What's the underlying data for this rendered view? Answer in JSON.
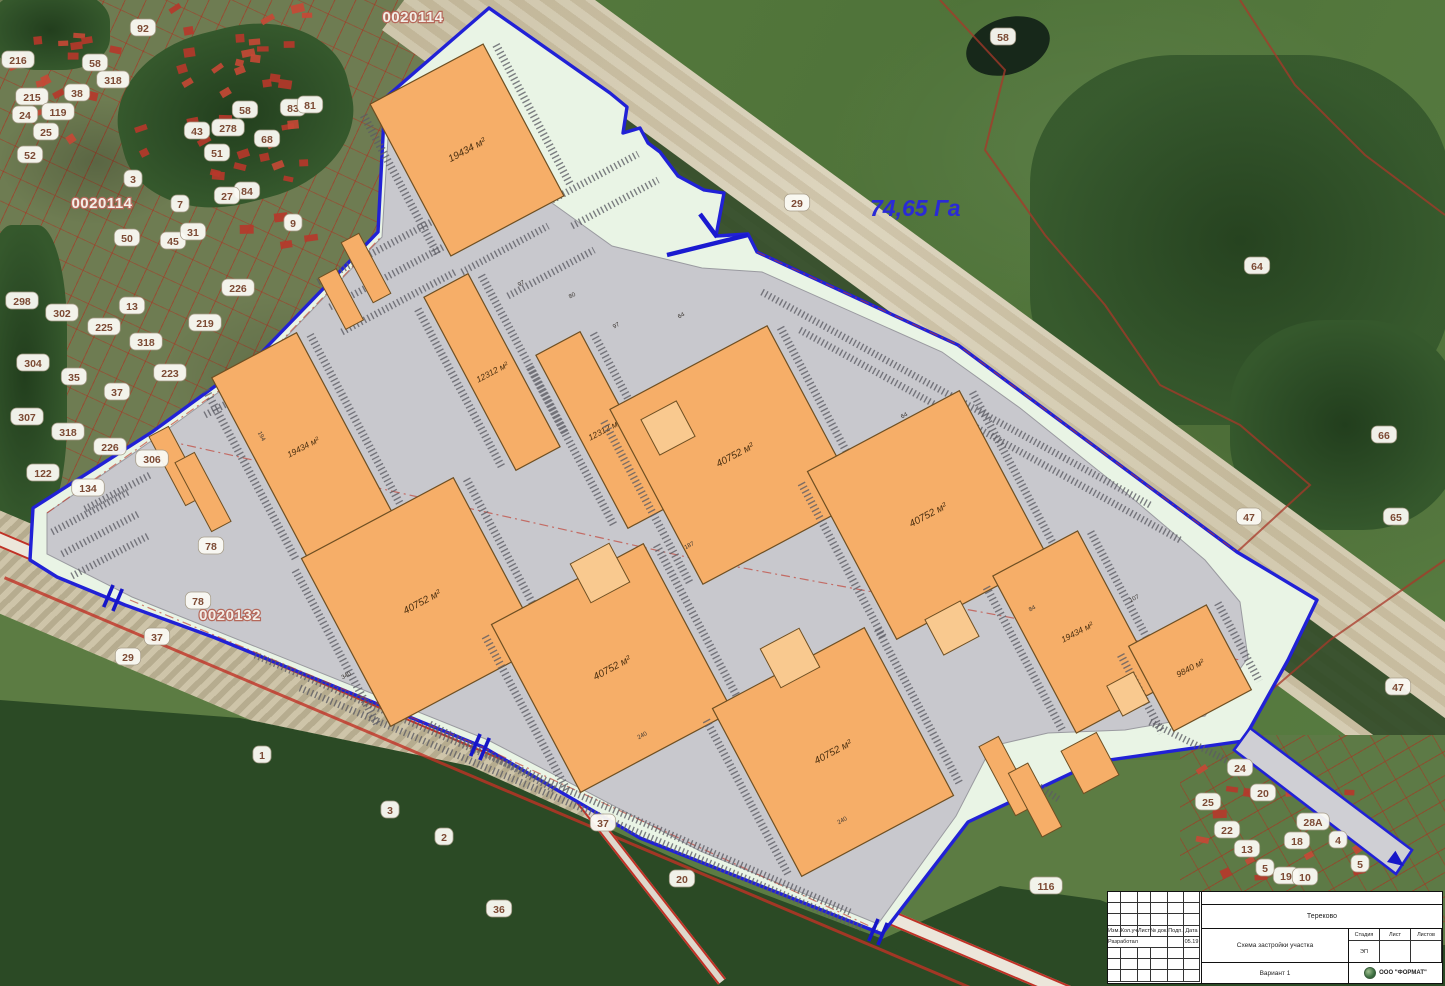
{
  "map": {
    "area_label": "74,65 Га",
    "cadastral_labels": [
      {
        "x": 413,
        "y": 22,
        "text": "0020114"
      },
      {
        "x": 102,
        "y": 208,
        "text": "0020114"
      },
      {
        "x": 230,
        "y": 620,
        "text": "0020132"
      }
    ],
    "buildings": [
      {
        "cx": 467,
        "cy": 150,
        "w": 128,
        "h": 172,
        "label": "19434 м²"
      },
      {
        "cx": 492,
        "cy": 372,
        "w": 50,
        "h": 196,
        "label": "12312 м²"
      },
      {
        "cx": 604,
        "cy": 430,
        "w": 50,
        "h": 196,
        "label": "12312 м²"
      },
      {
        "cx": 303,
        "cy": 447,
        "w": 96,
        "h": 208,
        "label": "19434 м²"
      },
      {
        "cx": 735,
        "cy": 455,
        "w": 178,
        "h": 198,
        "label": "40752 м²"
      },
      {
        "cx": 928,
        "cy": 515,
        "w": 172,
        "h": 190,
        "label": "40752 м²"
      },
      {
        "cx": 422,
        "cy": 602,
        "w": 172,
        "h": 190,
        "label": "40752 м²"
      },
      {
        "cx": 612,
        "cy": 668,
        "w": 172,
        "h": 190,
        "label": "40752 м²"
      },
      {
        "cx": 833,
        "cy": 752,
        "w": 172,
        "h": 190,
        "label": "40752 м²"
      },
      {
        "cx": 1077,
        "cy": 632,
        "w": 96,
        "h": 178,
        "label": "19434 м²"
      },
      {
        "cx": 1190,
        "cy": 668,
        "w": 88,
        "h": 96,
        "label": "9840 м²"
      }
    ],
    "dimension_labels": [
      {
        "x": 522,
        "y": 285,
        "t": "97"
      },
      {
        "x": 573,
        "y": 297,
        "t": "80"
      },
      {
        "x": 682,
        "y": 317,
        "t": "64"
      },
      {
        "x": 617,
        "y": 327,
        "t": "97"
      },
      {
        "x": 260,
        "y": 437,
        "t": "194",
        "r": 62
      },
      {
        "x": 1033,
        "y": 610,
        "t": "84"
      },
      {
        "x": 690,
        "y": 547,
        "t": "187"
      },
      {
        "x": 643,
        "y": 737,
        "t": "240"
      },
      {
        "x": 843,
        "y": 822,
        "t": "240"
      },
      {
        "x": 347,
        "y": 677,
        "t": "340"
      },
      {
        "x": 905,
        "y": 417,
        "t": "64"
      },
      {
        "x": 1135,
        "y": 600,
        "t": "107"
      }
    ],
    "parcel_bubbles": [
      {
        "x": 18,
        "y": 60,
        "t": "216"
      },
      {
        "x": 95,
        "y": 63,
        "t": "58"
      },
      {
        "x": 113,
        "y": 80,
        "t": "318"
      },
      {
        "x": 143,
        "y": 28,
        "t": "92"
      },
      {
        "x": 32,
        "y": 97,
        "t": "215"
      },
      {
        "x": 77,
        "y": 93,
        "t": "38"
      },
      {
        "x": 58,
        "y": 112,
        "t": "119"
      },
      {
        "x": 25,
        "y": 115,
        "t": "24"
      },
      {
        "x": 46,
        "y": 132,
        "t": "25"
      },
      {
        "x": 30,
        "y": 155,
        "t": "52"
      },
      {
        "x": 245,
        "y": 110,
        "t": "58"
      },
      {
        "x": 197,
        "y": 131,
        "t": "43"
      },
      {
        "x": 228,
        "y": 128,
        "t": "278"
      },
      {
        "x": 217,
        "y": 153,
        "t": "51"
      },
      {
        "x": 267,
        "y": 139,
        "t": "68"
      },
      {
        "x": 293,
        "y": 108,
        "t": "83"
      },
      {
        "x": 310,
        "y": 105,
        "t": "81"
      },
      {
        "x": 247,
        "y": 191,
        "t": "84"
      },
      {
        "x": 227,
        "y": 196,
        "t": "27"
      },
      {
        "x": 293,
        "y": 223,
        "t": "9"
      },
      {
        "x": 133,
        "y": 179,
        "t": "3"
      },
      {
        "x": 180,
        "y": 204,
        "t": "7"
      },
      {
        "x": 127,
        "y": 238,
        "t": "50"
      },
      {
        "x": 173,
        "y": 241,
        "t": "45"
      },
      {
        "x": 193,
        "y": 232,
        "t": "31"
      },
      {
        "x": 22,
        "y": 301,
        "t": "298"
      },
      {
        "x": 62,
        "y": 313,
        "t": "302"
      },
      {
        "x": 104,
        "y": 327,
        "t": "225"
      },
      {
        "x": 146,
        "y": 342,
        "t": "318"
      },
      {
        "x": 33,
        "y": 363,
        "t": "304"
      },
      {
        "x": 74,
        "y": 377,
        "t": "35"
      },
      {
        "x": 117,
        "y": 392,
        "t": "37"
      },
      {
        "x": 27,
        "y": 417,
        "t": "307"
      },
      {
        "x": 68,
        "y": 432,
        "t": "318"
      },
      {
        "x": 110,
        "y": 447,
        "t": "226"
      },
      {
        "x": 152,
        "y": 459,
        "t": "306"
      },
      {
        "x": 43,
        "y": 473,
        "t": "122"
      },
      {
        "x": 88,
        "y": 488,
        "t": "134"
      },
      {
        "x": 132,
        "y": 306,
        "t": "13"
      },
      {
        "x": 170,
        "y": 373,
        "t": "223"
      },
      {
        "x": 205,
        "y": 323,
        "t": "219"
      },
      {
        "x": 238,
        "y": 288,
        "t": "226"
      },
      {
        "x": 1003,
        "y": 37,
        "t": "58"
      },
      {
        "x": 797,
        "y": 203,
        "t": "29"
      },
      {
        "x": 1257,
        "y": 266,
        "t": "64"
      },
      {
        "x": 1384,
        "y": 435,
        "t": "66"
      },
      {
        "x": 1249,
        "y": 517,
        "t": "47"
      },
      {
        "x": 1396,
        "y": 517,
        "t": "65"
      },
      {
        "x": 1398,
        "y": 687,
        "t": "47"
      },
      {
        "x": 211,
        "y": 546,
        "t": "78"
      },
      {
        "x": 198,
        "y": 601,
        "t": "78"
      },
      {
        "x": 157,
        "y": 637,
        "t": "37"
      },
      {
        "x": 128,
        "y": 657,
        "t": "29"
      },
      {
        "x": 262,
        "y": 755,
        "t": "1"
      },
      {
        "x": 390,
        "y": 810,
        "t": "3"
      },
      {
        "x": 444,
        "y": 837,
        "t": "2"
      },
      {
        "x": 499,
        "y": 909,
        "t": "36"
      },
      {
        "x": 603,
        "y": 823,
        "t": "37"
      },
      {
        "x": 682,
        "y": 879,
        "t": "20"
      },
      {
        "x": 1046,
        "y": 886,
        "t": "116"
      },
      {
        "x": 1240,
        "y": 768,
        "t": "24"
      },
      {
        "x": 1263,
        "y": 793,
        "t": "20"
      },
      {
        "x": 1208,
        "y": 802,
        "t": "25"
      },
      {
        "x": 1227,
        "y": 830,
        "t": "22"
      },
      {
        "x": 1313,
        "y": 822,
        "t": "28А"
      },
      {
        "x": 1297,
        "y": 841,
        "t": "18"
      },
      {
        "x": 1338,
        "y": 840,
        "t": "4"
      },
      {
        "x": 1247,
        "y": 849,
        "t": "13"
      },
      {
        "x": 1286,
        "y": 876,
        "t": "19"
      },
      {
        "x": 1265,
        "y": 868,
        "t": "5"
      },
      {
        "x": 1305,
        "y": 877,
        "t": "10"
      },
      {
        "x": 1360,
        "y": 864,
        "t": "5"
      }
    ]
  },
  "title_block": {
    "project_name": "Тереково",
    "document_title": "Схема застройки участка",
    "variant": "Вариант 1",
    "company": "ООО \"ФОРМАТ\"",
    "columns": [
      "Изм.",
      "Кол.уч",
      "Лист",
      "№ док.",
      "Подп.",
      "Дата"
    ],
    "developed_by_label": "Разработал",
    "date_value": "05.19",
    "stage_label": "Стадия",
    "sheet_label": "Лист",
    "sheets_label": "Листов",
    "stage_value": "ЭП"
  },
  "colors": {
    "boundary": "#2121d6",
    "site_fill": "#e9f4e5",
    "paved": "#c8c8cd",
    "building": "#f6ae68",
    "annex": "#f9c98f",
    "building_outline": "#6e4f22",
    "red_line": "#c0392b",
    "area_label": "#2a2ad6"
  }
}
